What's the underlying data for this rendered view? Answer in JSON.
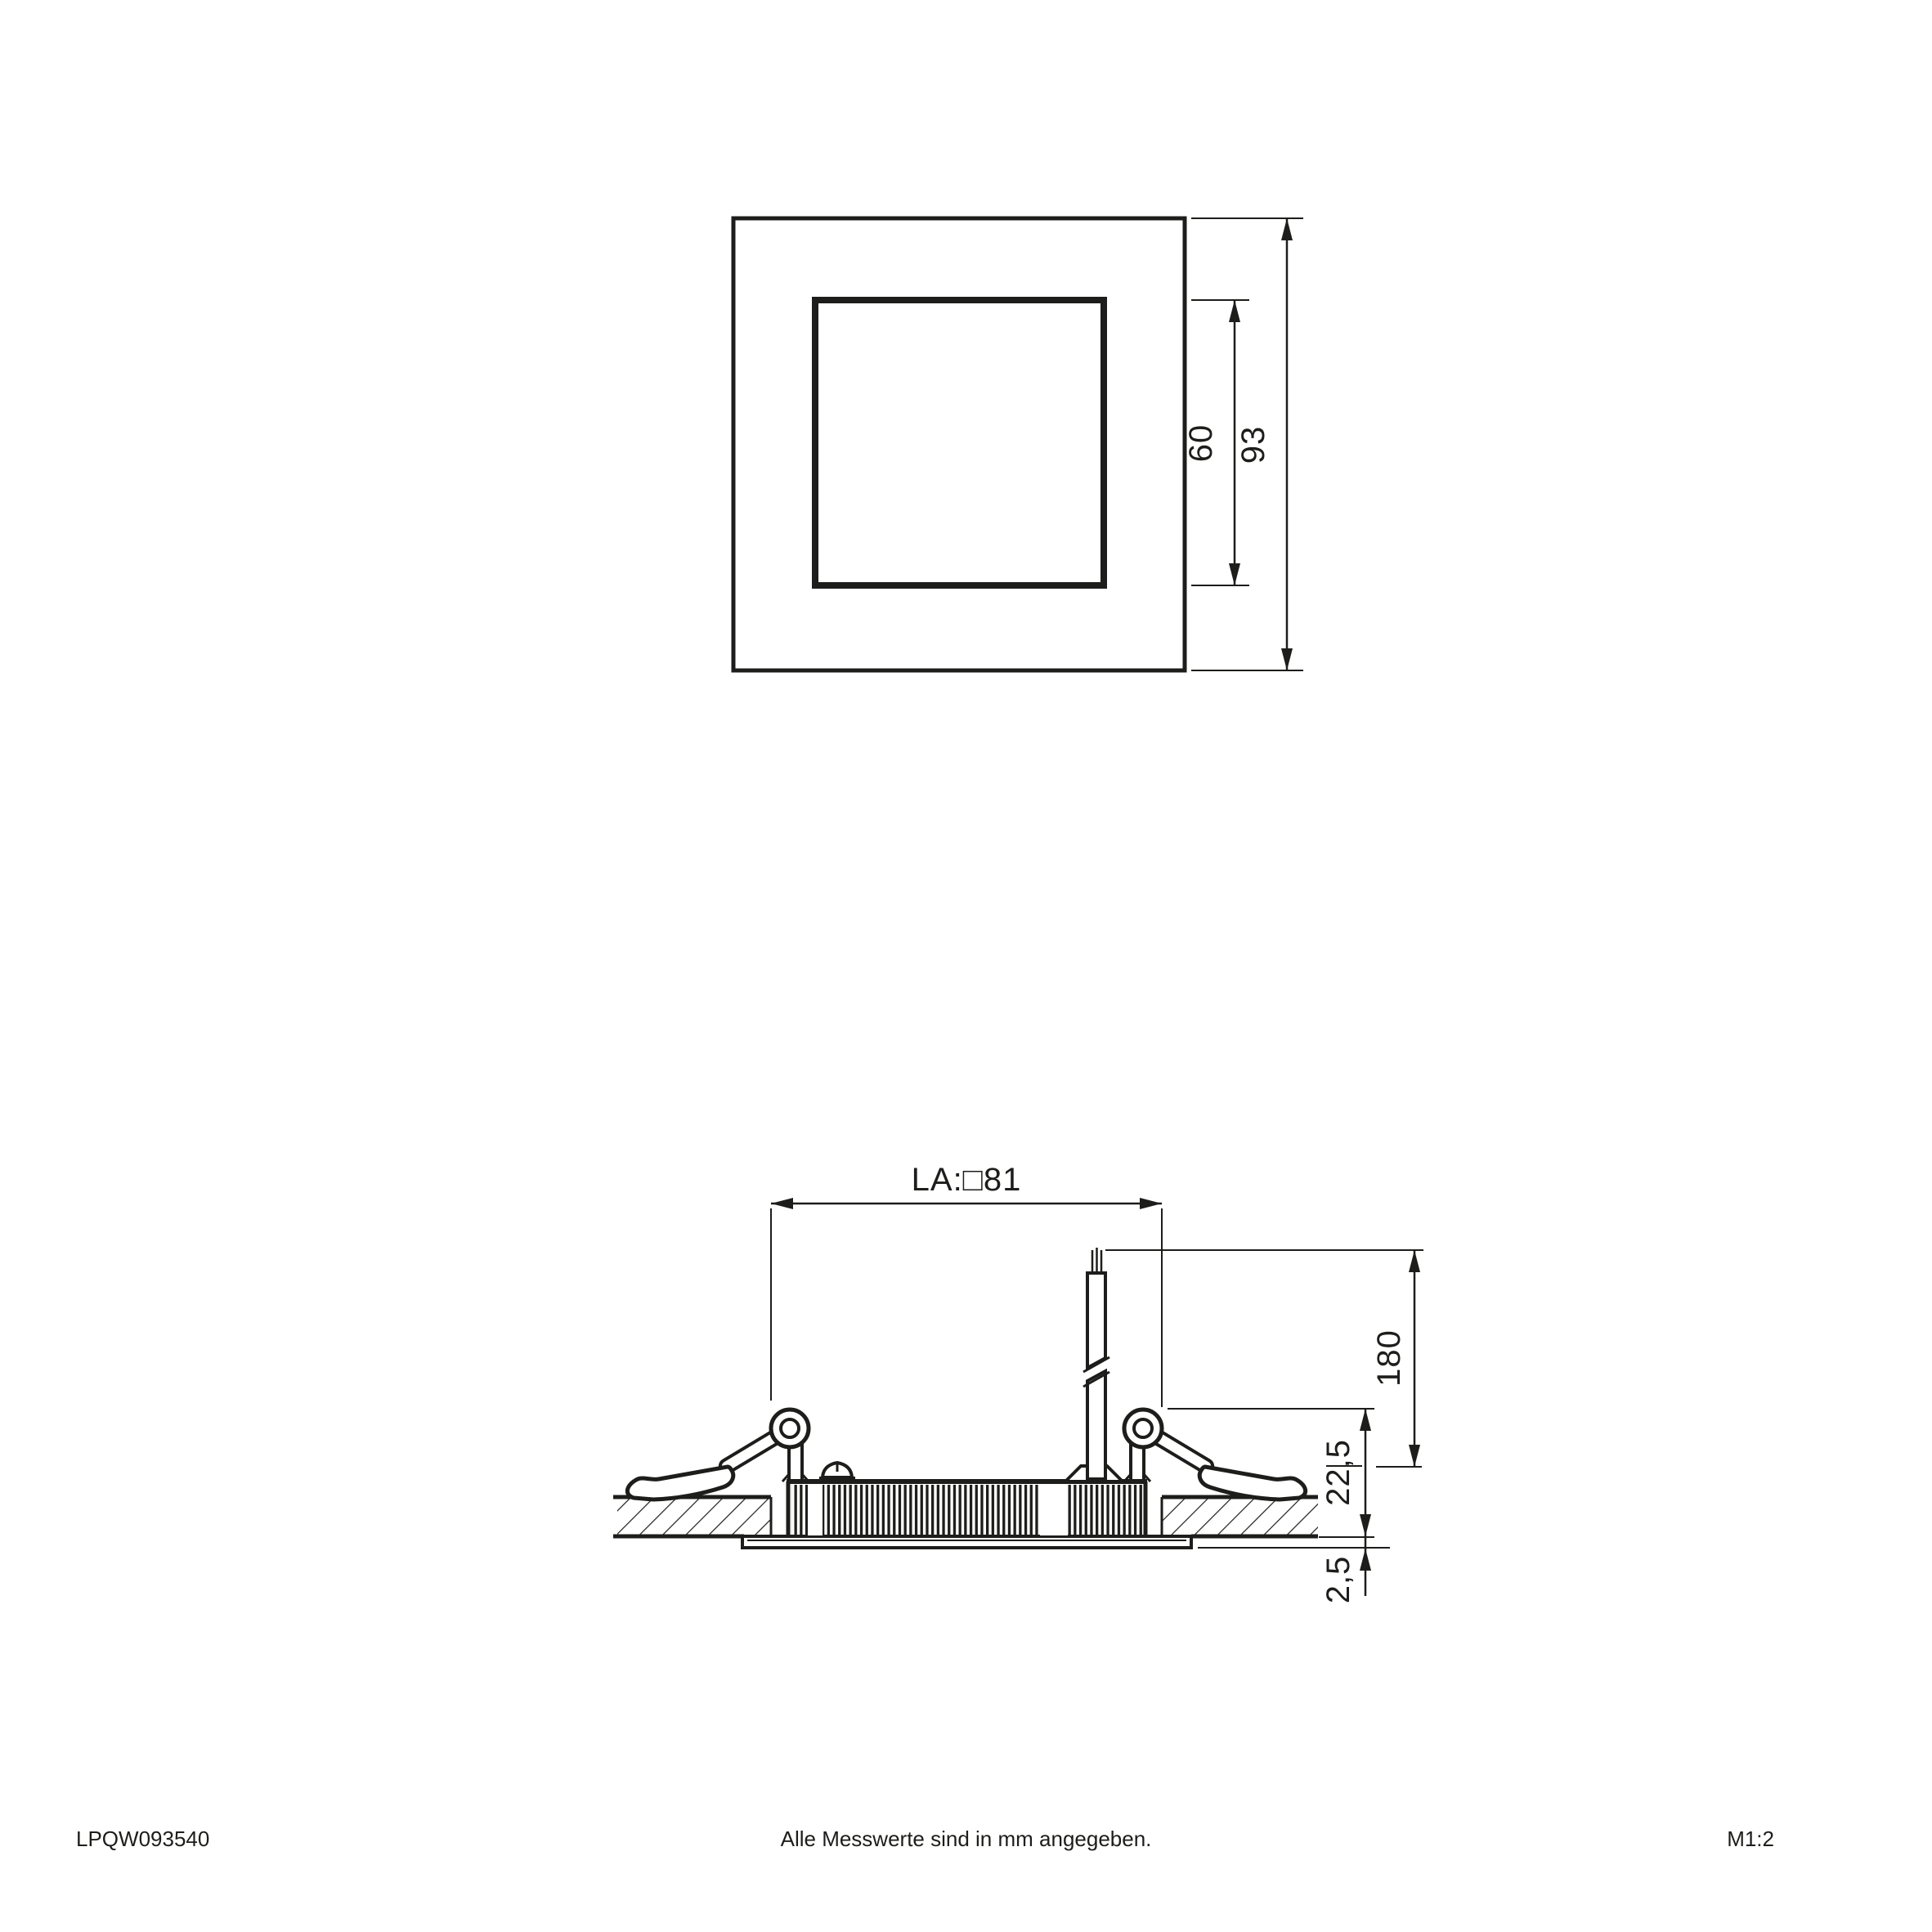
{
  "colors": {
    "line": "#1d1d1b",
    "background": "#ffffff"
  },
  "top_view": {
    "dim_inner": "60",
    "dim_outer": "93"
  },
  "side_view": {
    "dim_cutout": "LA:□81",
    "dim_cable_length": "180",
    "dim_recess_depth": "22,5",
    "dim_trim_height": "2,5"
  },
  "footer": {
    "doc_number": "LPQW093540",
    "note": "Alle Messwerte sind in mm angegeben.",
    "scale": "M1:2"
  }
}
